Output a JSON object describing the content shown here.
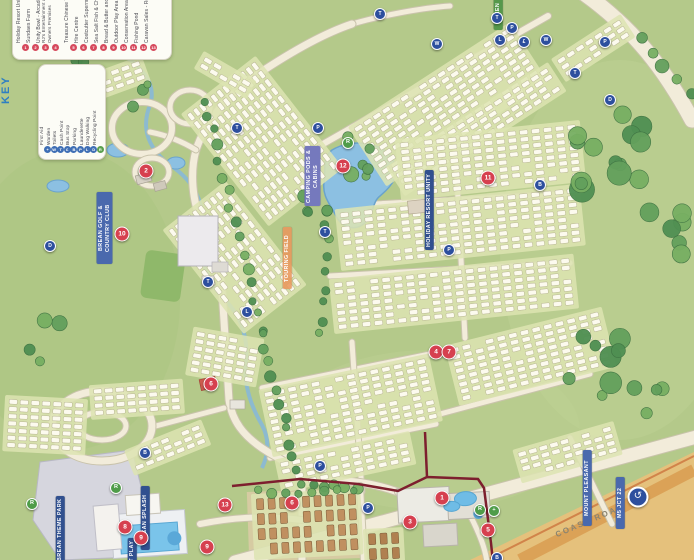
{
  "map_title": "Holiday resort caravan park map",
  "key": {
    "title": "KEY",
    "red_items": [
      {
        "n": "1",
        "label": "Holiday Resort Unity"
      },
      {
        "n": "2",
        "label": "Sundaes Farm"
      },
      {
        "n": "3",
        "label": "Unity Bowl - Arcade"
      },
      {
        "n": "4",
        "label": "RJ's Entertainment and Owners Premises"
      },
      {
        "n": "5",
        "label": "Treasure Chinese Takeaway"
      },
      {
        "n": "6",
        "label": "Hire Centre"
      },
      {
        "n": "7",
        "label": "Costcutter Supermarket"
      },
      {
        "n": "8",
        "label": "Sea Salt Fish & Chips"
      },
      {
        "n": "9",
        "label": "Bread & Butter and Bakery"
      },
      {
        "n": "10",
        "label": "Outdoor Play Area"
      },
      {
        "n": "11",
        "label": "Conservation Area"
      },
      {
        "n": "12",
        "label": "Fishing Pond"
      },
      {
        "n": "13",
        "label": "Caravan Sales - Reception"
      }
    ],
    "blue_items": [
      {
        "icon": "+",
        "label": "First Aid"
      },
      {
        "icon": "W",
        "label": "Warden"
      },
      {
        "icon": "T",
        "label": "Toilets"
      },
      {
        "icon": "£",
        "label": "Cash Point"
      },
      {
        "icon": "B",
        "label": "Bus Stop"
      },
      {
        "icon": "P",
        "label": "Parking"
      },
      {
        "icon": "L",
        "label": "Launderette"
      },
      {
        "icon": "D",
        "label": "Dog Walking"
      },
      {
        "icon": "R",
        "label": "Recycling Point"
      }
    ]
  },
  "labels": [
    {
      "text": "BREAN GOLF & COUNTRY CLUB",
      "cls": "navy",
      "x": 97,
      "y": 192,
      "h": 68
    },
    {
      "text": "CAMPING PODS & CABINS",
      "cls": "purple",
      "x": 305,
      "y": 146,
      "h": 56
    },
    {
      "text": "TOURING FIELD",
      "cls": "orange",
      "x": 283,
      "y": 227,
      "h": 58
    },
    {
      "text": "HOLIDAY RESORT UNITY",
      "cls": "navy2",
      "x": 425,
      "y": 170,
      "h": 76
    },
    {
      "text": "GREEN",
      "cls": "green",
      "x": 494,
      "y": -4,
      "h": 30
    },
    {
      "text": "MOUNT PLEASANT",
      "cls": "blue",
      "x": 583,
      "y": 450,
      "h": 72
    },
    {
      "text": "M5 JCT 22",
      "cls": "blue",
      "x": 616,
      "y": 477,
      "h": 48
    },
    {
      "text": "BREAN THEME PARK",
      "cls": "navy2",
      "x": 56,
      "y": 496,
      "h": 64
    },
    {
      "text": "BREAN SPLASH",
      "cls": "navy2",
      "x": 141,
      "y": 486,
      "h": 60
    },
    {
      "text": "SOFT PLAY",
      "cls": "navy2",
      "x": 128,
      "y": 538,
      "h": 34
    }
  ],
  "road_label": {
    "text": "COAST ROAD",
    "x": 553,
    "y": 516
  },
  "roundabout_sign": {
    "glyph": "↺",
    "x": 638,
    "y": 497
  },
  "markers": {
    "red": [
      {
        "n": "1",
        "x": 442,
        "y": 498
      },
      {
        "n": "2",
        "x": 146,
        "y": 171
      },
      {
        "n": "3",
        "x": 410,
        "y": 522
      },
      {
        "n": "4",
        "x": 436,
        "y": 352
      },
      {
        "n": "5",
        "x": 488,
        "y": 530
      },
      {
        "n": "6",
        "x": 211,
        "y": 384
      },
      {
        "n": "7",
        "x": 449,
        "y": 352
      },
      {
        "n": "8",
        "x": 125,
        "y": 527
      },
      {
        "n": "9",
        "x": 141,
        "y": 538
      },
      {
        "n": "10",
        "x": 122,
        "y": 234
      },
      {
        "n": "11",
        "x": 488,
        "y": 178
      },
      {
        "n": "12",
        "x": 343,
        "y": 166
      },
      {
        "n": "13",
        "x": 225,
        "y": 505
      },
      {
        "n": "6",
        "x": 292,
        "y": 503
      },
      {
        "n": "9",
        "x": 207,
        "y": 547
      }
    ],
    "blue": [
      {
        "icon": "T",
        "x": 237,
        "y": 128
      },
      {
        "icon": "P",
        "x": 318,
        "y": 128
      },
      {
        "icon": "T",
        "x": 380,
        "y": 14
      },
      {
        "icon": "T",
        "x": 497,
        "y": 18
      },
      {
        "icon": "P",
        "x": 512,
        "y": 28
      },
      {
        "icon": "L",
        "x": 500,
        "y": 40
      },
      {
        "icon": "£",
        "x": 524,
        "y": 42
      },
      {
        "icon": "W",
        "x": 546,
        "y": 40
      },
      {
        "icon": "P",
        "x": 605,
        "y": 42
      },
      {
        "icon": "T",
        "x": 575,
        "y": 73
      },
      {
        "icon": "D",
        "x": 610,
        "y": 100
      },
      {
        "icon": "B",
        "x": 540,
        "y": 185
      },
      {
        "icon": "T",
        "x": 325,
        "y": 232
      },
      {
        "icon": "D",
        "x": 50,
        "y": 246
      },
      {
        "icon": "T",
        "x": 208,
        "y": 282
      },
      {
        "icon": "P",
        "x": 449,
        "y": 250
      },
      {
        "icon": "L",
        "x": 247,
        "y": 312
      },
      {
        "icon": "B",
        "x": 145,
        "y": 453
      },
      {
        "icon": "W",
        "x": 437,
        "y": 44
      },
      {
        "icon": "B",
        "x": 497,
        "y": 558
      },
      {
        "icon": "P",
        "x": 320,
        "y": 466
      },
      {
        "icon": "P",
        "x": 368,
        "y": 508
      }
    ],
    "green": [
      {
        "icon": "R",
        "x": 32,
        "y": 504
      },
      {
        "icon": "R",
        "x": 116,
        "y": 488
      },
      {
        "icon": "R",
        "x": 348,
        "y": 143
      },
      {
        "icon": "R",
        "x": 480,
        "y": 510
      },
      {
        "icon": "+",
        "x": 494,
        "y": 511
      }
    ]
  },
  "colors": {
    "grass": "#b4c98a",
    "field_strip": "#dde4b2",
    "plot": "#fcfaee",
    "road": "#f2ecda",
    "water": "#85b7dc",
    "lake": "#8cc0e2",
    "tree_dark": "#4f8f52",
    "marker_red": "#d6404f",
    "marker_blue": "#2d4f9e",
    "boundary": "#7d1f2e",
    "beach": "#e5c17c",
    "theme_park": "#d6d6de"
  }
}
